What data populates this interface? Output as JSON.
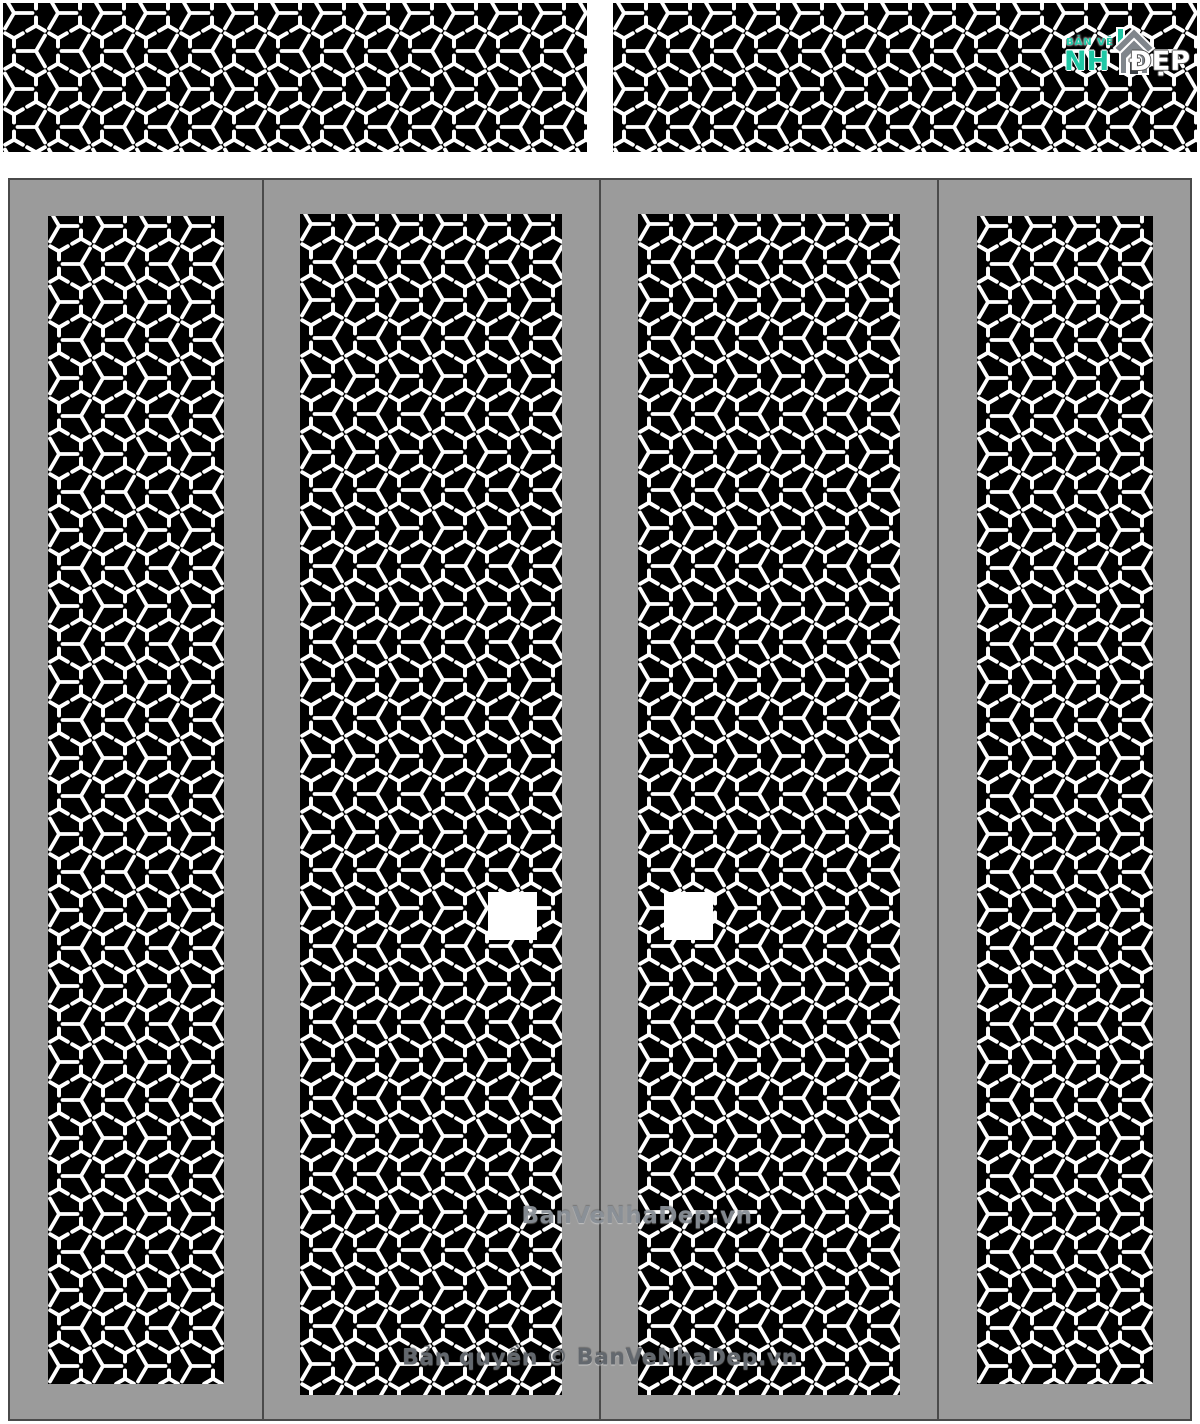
{
  "colors": {
    "panel_black": "#000000",
    "pattern_white": "#ffffff",
    "frame_gray": "#9b9b9b",
    "line_dark": "#4a4a4a",
    "accent_teal": "#1ec8a5",
    "house_gray": "#80868c",
    "watermark_gray": "#8a9097",
    "copyright_gray": "#63686e",
    "page_bg": "#ffffff"
  },
  "logo": {
    "tagline": "BẢN VẼ",
    "name_left": "NH",
    "name_right": "ĐẸP",
    "icon": "house-icon"
  },
  "watermark": {
    "text": "BanVeNhaDep.vn"
  },
  "footer": {
    "text": "Bản quyền © BanVeNhaDep.vn"
  },
  "pattern": {
    "name": "hexagon-y-lattice",
    "cell_width": 44,
    "cell_height": 76,
    "stroke_width": 3.8
  },
  "structure": {
    "top_rails": 2,
    "door_leaves": 4,
    "cnc_panels": 6,
    "handles": 2
  }
}
